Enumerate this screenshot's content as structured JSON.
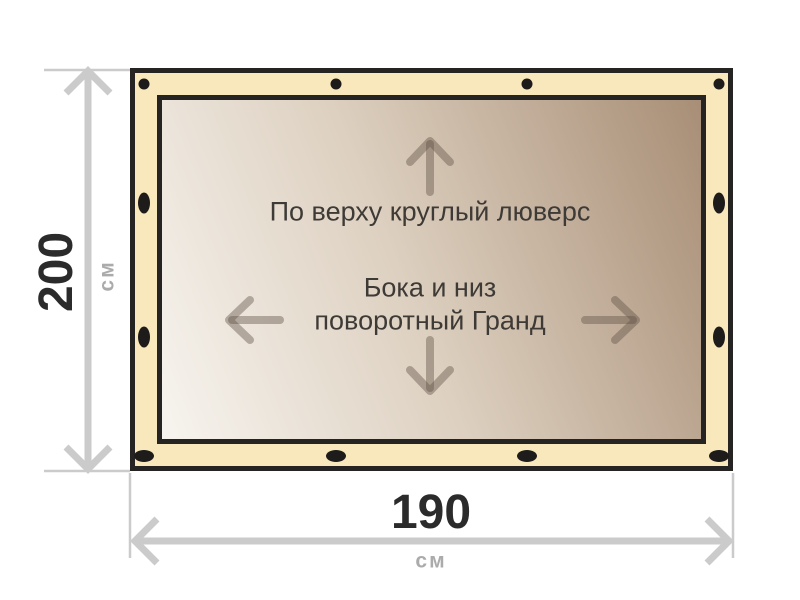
{
  "banner": {
    "label_top": "По верху круглый люверс",
    "label_sides_line1": "Бока и низ",
    "label_sides_line2": "поворотный Гранд",
    "grommets": {
      "top_edge": {
        "type": "round",
        "count": 4
      },
      "bottom_edge": {
        "type": "oval",
        "count": 4
      },
      "left_edge": {
        "type": "oval",
        "count": 2
      },
      "right_edge": {
        "type": "oval",
        "count": 2
      }
    },
    "colors": {
      "band": "#f8e8bc",
      "border": "#262422",
      "grommet": "#1d1c1b",
      "gradient_light": "#f7f4ef",
      "gradient_dark": "#a88e76",
      "inner_arrow": "#5f5244",
      "text": "#3e3a36"
    }
  },
  "dimensions": {
    "height": {
      "value": "200",
      "unit": "см"
    },
    "width": {
      "value": "190",
      "unit": "см"
    },
    "line_color": "#cbcbcb",
    "value_color": "#2b2b2b",
    "unit_color": "#ababab"
  }
}
